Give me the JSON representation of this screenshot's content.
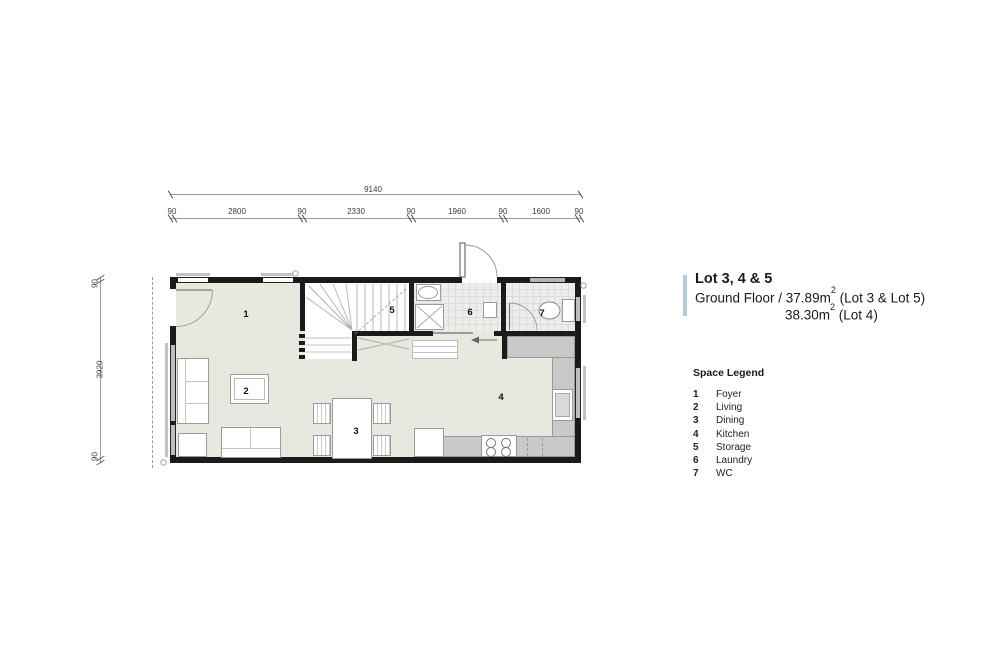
{
  "dimensions": {
    "total_width": "9140",
    "top_segments": [
      "90",
      "2800",
      "90",
      "2330",
      "90",
      "1960",
      "90",
      "1600",
      "90"
    ],
    "side_segments": [
      "90",
      "3920",
      "90"
    ]
  },
  "plan": {
    "room_numbers": [
      "1",
      "2",
      "3",
      "4",
      "5",
      "6",
      "7"
    ]
  },
  "title_block": {
    "lot_title": "Lot 3, 4 & 5",
    "floor_label": "Ground Floor / 37.89m",
    "floor_sup": "2",
    "floor_suffix": " (Lot 3 & Lot 5)",
    "area2_label": "38.30m",
    "area2_sup": "2",
    "area2_suffix": " (Lot 4)"
  },
  "legend": {
    "heading": "Space Legend",
    "items": [
      {
        "num": "1",
        "label": "Foyer"
      },
      {
        "num": "2",
        "label": "Living"
      },
      {
        "num": "3",
        "label": "Dining"
      },
      {
        "num": "4",
        "label": "Kitchen"
      },
      {
        "num": "5",
        "label": "Storage"
      },
      {
        "num": "6",
        "label": "Laundry"
      },
      {
        "num": "7",
        "label": "WC"
      }
    ]
  },
  "colors": {
    "accent_bar": "#b3cdd6",
    "wall": "#1b1b1b",
    "floor": "#e9e8e0",
    "counter": "#c9c9c9",
    "tile": "#eeedeb"
  }
}
